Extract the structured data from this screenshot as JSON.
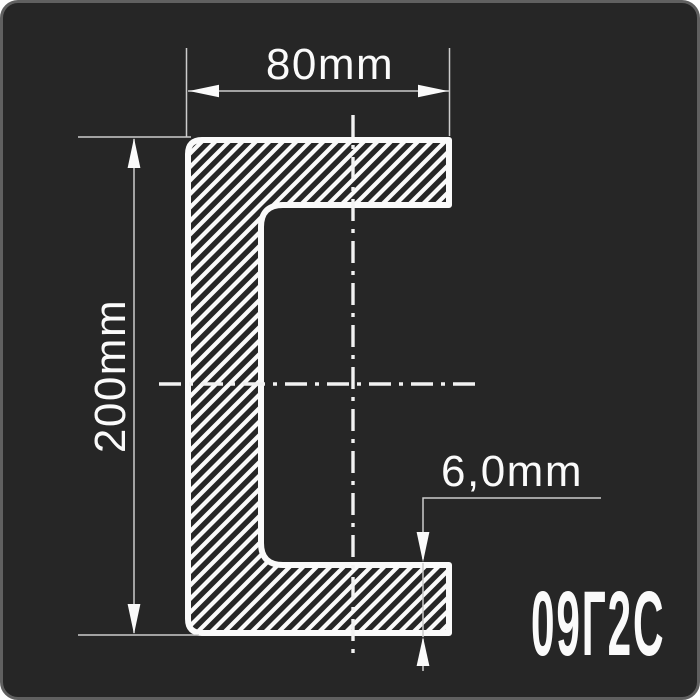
{
  "page": {
    "background": "#ffffff"
  },
  "card": {
    "background": "#262626",
    "border_color": "#606060"
  },
  "drawing": {
    "type": "channel-steel-cross-section",
    "dimensions": {
      "width_label": "80mm",
      "height_label": "200mm",
      "thickness_label": "6,0mm"
    },
    "steel_grade": "09Г2С",
    "colors": {
      "profile_outline": "#fafafa",
      "hatch": "#fafafa",
      "thin_line": "#cccccc",
      "centerline": "#f2f2f2",
      "text": "#fafafa"
    }
  }
}
